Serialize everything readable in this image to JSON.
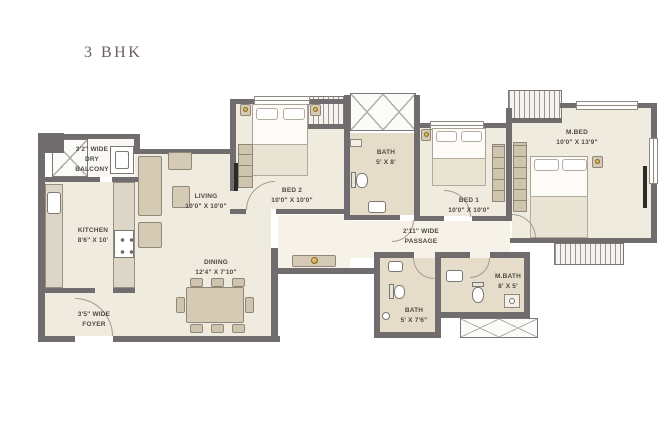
{
  "title": "3 BHK",
  "colors": {
    "wall": "#716d6e",
    "floor": "#f0ebdf",
    "floor-light": "#f6f2e8",
    "bath": "#e5ddc9",
    "furniture": "#d5cab4",
    "furniture-border": "#8f887a",
    "line": "#a29c90",
    "text": "#4e4942",
    "title": "#6b5e64"
  },
  "rooms": {
    "dry_balcony": {
      "lines": [
        "3'2\" WIDE",
        "DRY",
        "BALCONY"
      ]
    },
    "kitchen": {
      "name": "KITCHEN",
      "dims": "8'6\" X 10'"
    },
    "living": {
      "name": "LIVING",
      "dims": "10'0\" X 10'0\""
    },
    "dining": {
      "name": "DINING",
      "dims": "12'4\" X 7'10\""
    },
    "foyer": {
      "lines": [
        "3'5\" WIDE",
        "FOYER"
      ]
    },
    "bed2": {
      "name": "BED 2",
      "dims": "10'0\" X 10'0\""
    },
    "bath_top": {
      "name": "BATH",
      "dims": "5' X 8'"
    },
    "bed1": {
      "name": "BED 1",
      "dims": "10'0\" X 10'0\""
    },
    "master_bed": {
      "name": "M.BED",
      "dims": "10'0\" X 13'9\""
    },
    "passage": {
      "lines": [
        "2'11\" WIDE",
        "PASSAGE"
      ]
    },
    "bath_bottom": {
      "name": "BATH",
      "dims": "5' X 7'6\""
    },
    "master_bath": {
      "name": "M.BATH",
      "dims": "8' X 5'"
    }
  }
}
